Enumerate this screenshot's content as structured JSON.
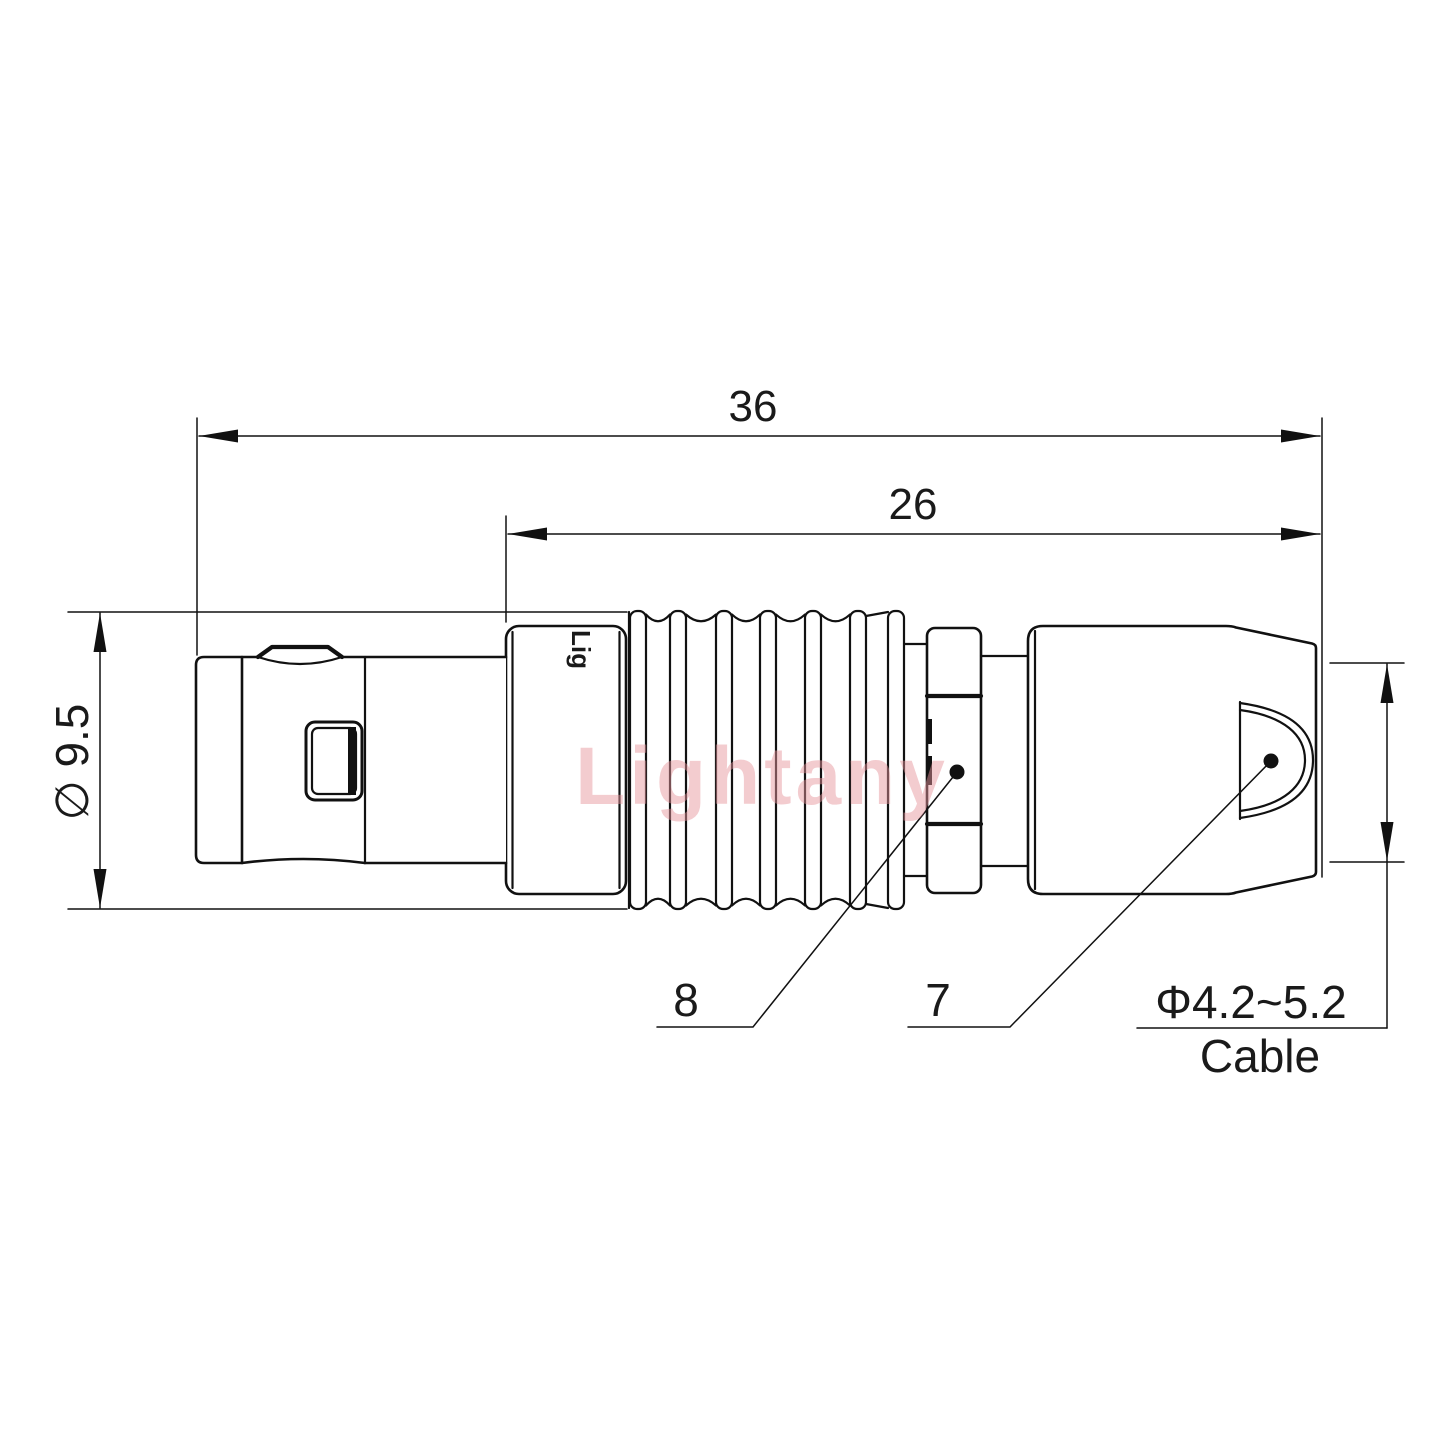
{
  "drawing": {
    "dim_overall_length": "36",
    "dim_rear_length": "26",
    "dim_diameter": "∅ 9.5",
    "callout_8": "8",
    "callout_7": "7",
    "cable_dim": "Φ4.2~5.2",
    "cable_word": "Cable"
  },
  "watermark": {
    "text": "Lightany",
    "engraving": "Lig",
    "color": "#e8959d"
  },
  "colors": {
    "line": "#111111",
    "text": "#1a1a1a",
    "background": "#ffffff"
  }
}
